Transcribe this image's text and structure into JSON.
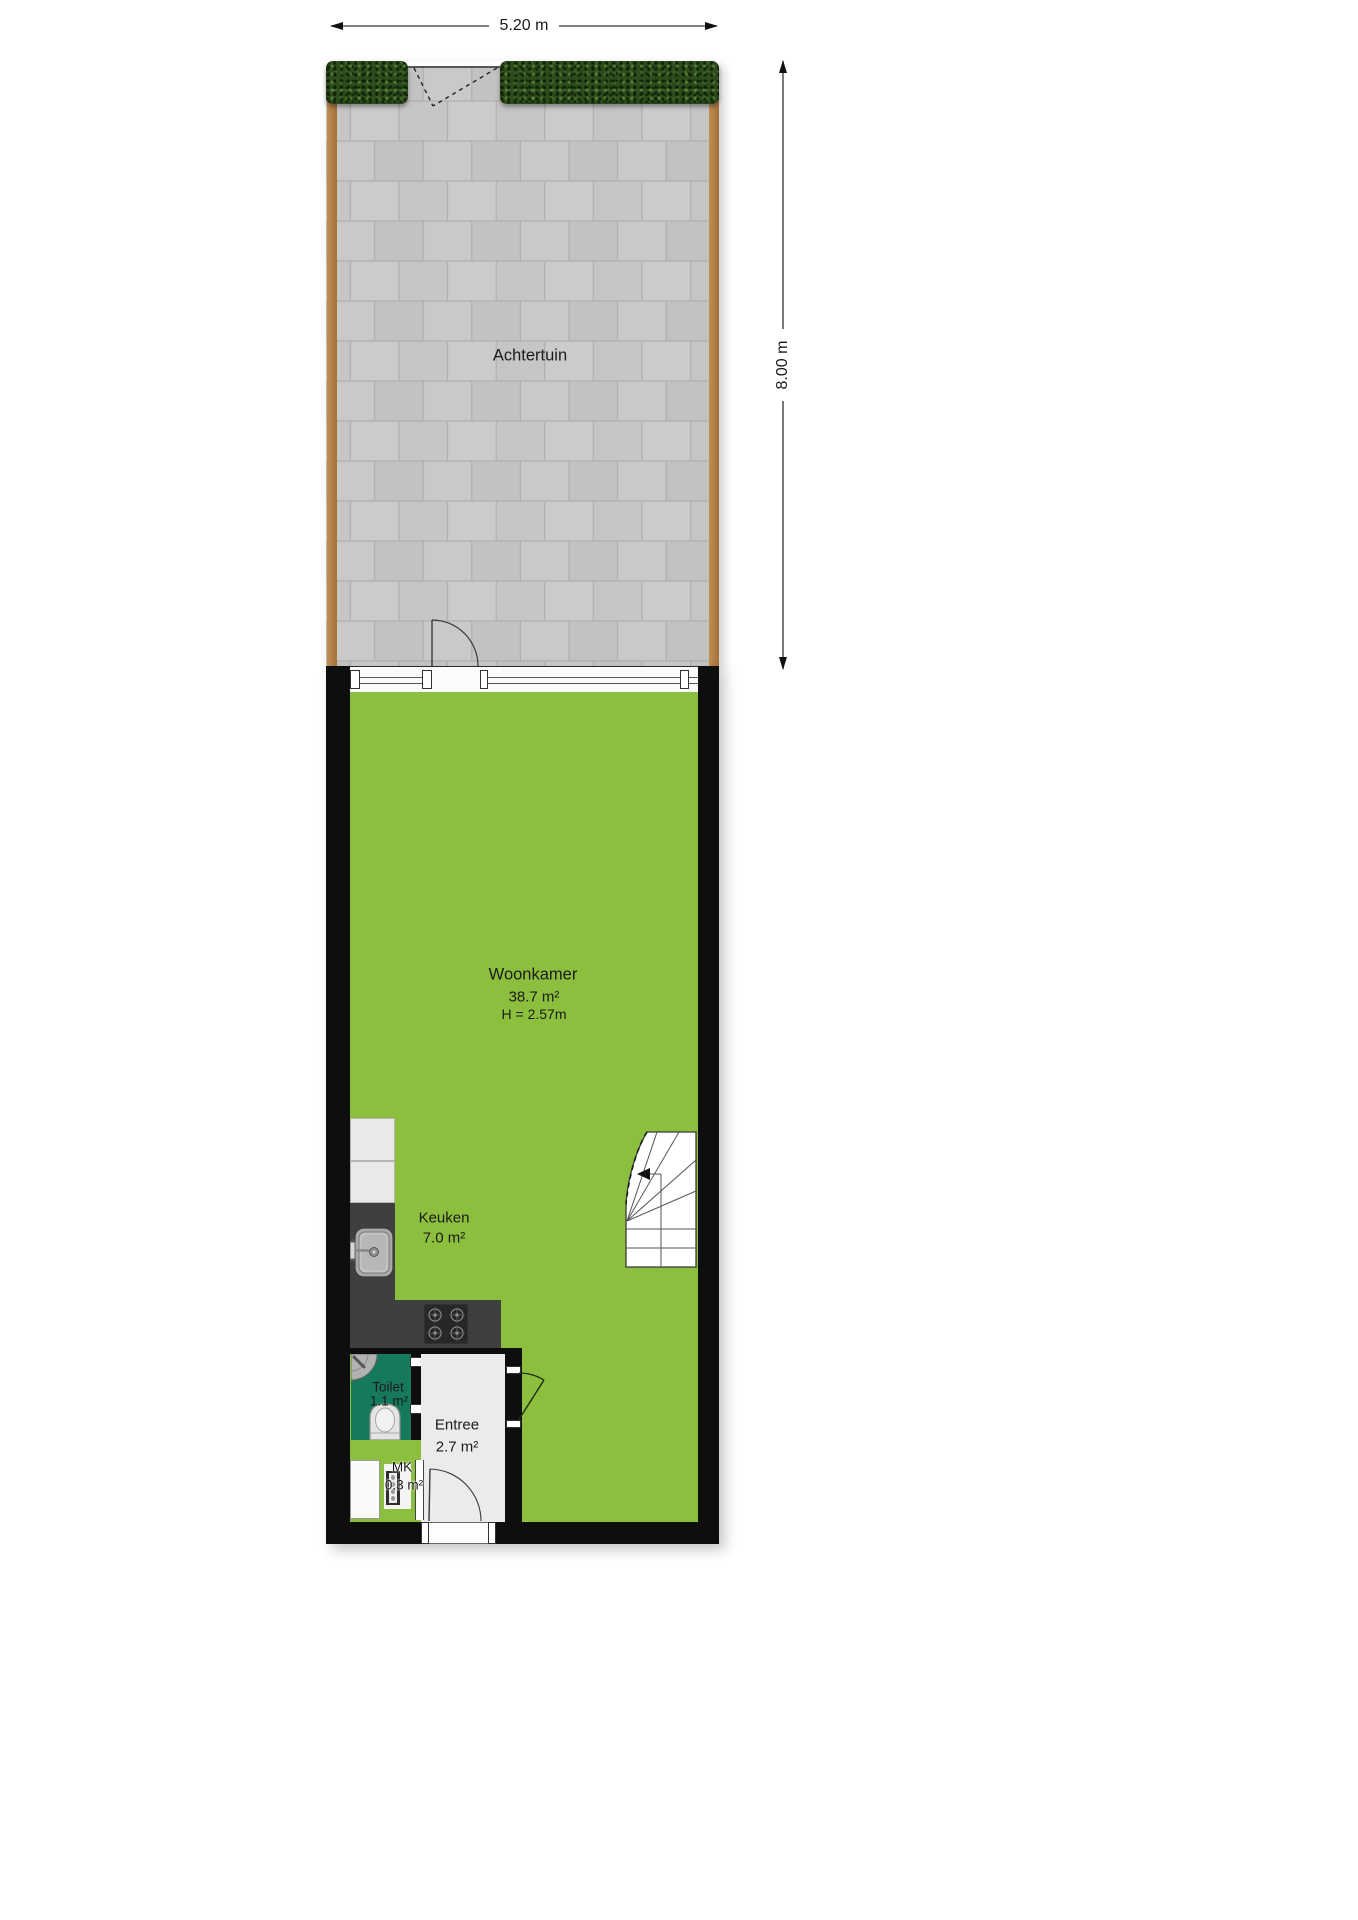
{
  "dimensions": {
    "width": "5.20 m",
    "depth": "8.00 m"
  },
  "rooms": {
    "achtertuin": {
      "name": "Achtertuin"
    },
    "woonkamer": {
      "name": "Woonkamer",
      "area": "38.7 m²",
      "ceiling_height": "H = 2.57m"
    },
    "keuken": {
      "name": "Keuken",
      "area": "7.0 m²"
    },
    "toilet": {
      "name": "Toilet",
      "area": "1.1 m²"
    },
    "entree": {
      "name": "Entree",
      "area": "2.7 m²"
    },
    "mk": {
      "name": "MK",
      "area": "0.3 m²"
    }
  },
  "colors": {
    "living_floor": "#8cbf3d",
    "toilet_floor": "#16795b",
    "entree_floor": "#ebebe9",
    "wall": "#0e0e0e",
    "paving": "#c7c7c5",
    "hedge": "#2e4b1c",
    "fence": "#b28049",
    "counter_dark": "#3e4040",
    "counter_light": "#e9e9e7"
  }
}
